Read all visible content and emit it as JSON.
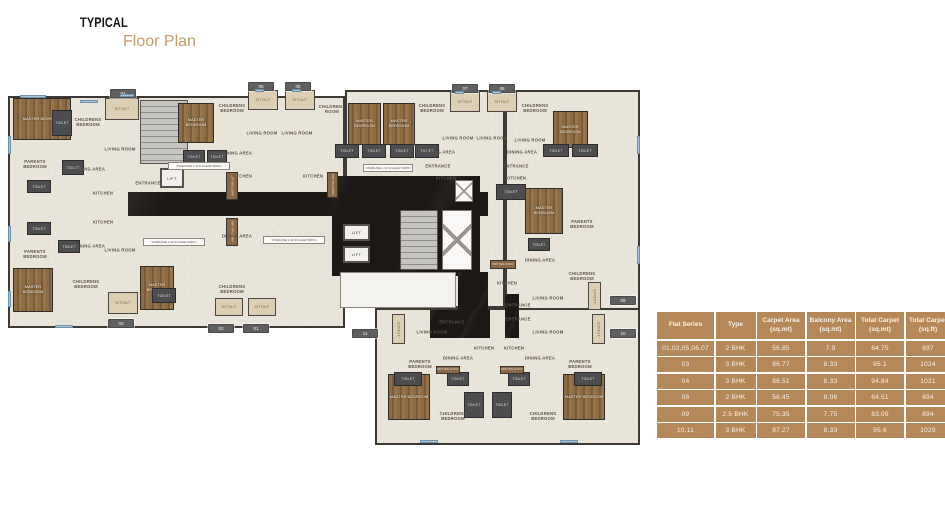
{
  "title": {
    "line1": "TYPICAL",
    "line2": "Floor Plan"
  },
  "colors": {
    "accent_gold": "#c49a6b",
    "table_tan": "#b5885a",
    "plan_floor_cream": "#e9e4d9",
    "plan_wall_dark": "#3d3a35",
    "plan_corridor_black": "#1b1815",
    "plan_wood_brown": "#85643f",
    "plan_toilet_gray": "#4d4d4f",
    "window_blue": "#a7c4da"
  },
  "table": {
    "headers": [
      "Flat Series",
      "Type",
      "Carpet Area (sq.mt)",
      "Balcony Area (sq.mt)",
      "Total Carpet (sq.mt)",
      "Total Carpet (sq.ft)"
    ],
    "rows": [
      [
        "01,02,05,06,07",
        "2 BHK",
        "56.85",
        "7.9",
        "64.75",
        "697"
      ],
      [
        "03",
        "3 BHK",
        "86.77",
        "8.33",
        "95.1",
        "1024"
      ],
      [
        "04",
        "3 BHK",
        "86.51",
        "8.33",
        "94.84",
        "1021"
      ],
      [
        "08",
        "2 BHK",
        "56.45",
        "8.06",
        "64.51",
        "694"
      ],
      [
        "09",
        "2.5 BHK",
        "75.35",
        "7.75",
        "83.09",
        "894"
      ],
      [
        "10,11",
        "3 BHK",
        "87.27",
        "8.33",
        "95.6",
        "1029"
      ]
    ]
  },
  "floor_plan": {
    "wings": [
      {
        "x": 8,
        "y": 20,
        "w": 337,
        "h": 232
      },
      {
        "x": 345,
        "y": 14,
        "w": 160,
        "h": 218
      },
      {
        "x": 505,
        "y": 14,
        "w": 135,
        "h": 238
      },
      {
        "x": 375,
        "y": 232,
        "w": 265,
        "h": 137
      }
    ],
    "corridors": [
      {
        "x": 128,
        "y": 116,
        "w": 360,
        "h": 24
      },
      {
        "x": 332,
        "y": 100,
        "w": 148,
        "h": 100
      },
      {
        "x": 458,
        "y": 196,
        "w": 30,
        "h": 66
      },
      {
        "x": 430,
        "y": 234,
        "w": 60,
        "h": 28
      },
      {
        "x": 505,
        "y": 218,
        "w": 14,
        "h": 44
      }
    ],
    "lobbies": [
      {
        "x": 340,
        "y": 196,
        "w": 116,
        "h": 36
      }
    ],
    "stairs": [
      {
        "x": 140,
        "y": 24,
        "w": 48,
        "h": 64
      },
      {
        "x": 400,
        "y": 134,
        "w": 38,
        "h": 60
      }
    ],
    "shafts": [
      {
        "x": 442,
        "y": 134,
        "w": 30,
        "h": 60
      },
      {
        "x": 455,
        "y": 104,
        "w": 18,
        "h": 22
      }
    ],
    "lifts": [
      {
        "label": "LIFT",
        "x": 160,
        "y": 92,
        "w": 24,
        "h": 20
      },
      {
        "label": "LIFT",
        "x": 343,
        "y": 148,
        "w": 27,
        "h": 17
      },
      {
        "label": "LIFT",
        "x": 343,
        "y": 170,
        "w": 27,
        "h": 17
      }
    ],
    "wood_rooms": [
      {
        "label": "MASTER BEDROOM",
        "x": 13,
        "y": 22,
        "w": 58,
        "h": 42
      },
      {
        "label": "MASTER BEDROOM",
        "x": 178,
        "y": 27,
        "w": 36,
        "h": 40
      },
      {
        "label": "MASTER BEDROOM",
        "x": 348,
        "y": 27,
        "w": 33,
        "h": 42
      },
      {
        "label": "MASTER BEDROOM",
        "x": 383,
        "y": 27,
        "w": 32,
        "h": 42
      },
      {
        "label": "MASTER BEDROOM",
        "x": 553,
        "y": 35,
        "w": 35,
        "h": 37
      },
      {
        "label": "MASTER BEDROOM",
        "x": 525,
        "y": 112,
        "w": 38,
        "h": 46
      },
      {
        "label": "MASTER BEDROOM",
        "x": 13,
        "y": 192,
        "w": 40,
        "h": 44
      },
      {
        "label": "MASTER BEDROOM",
        "x": 140,
        "y": 190,
        "w": 34,
        "h": 44
      },
      {
        "label": "MASTER BEDROOM",
        "x": 388,
        "y": 298,
        "w": 42,
        "h": 46
      },
      {
        "label": "MASTER BEDROOM",
        "x": 563,
        "y": 298,
        "w": 42,
        "h": 46
      }
    ],
    "toilets": [
      {
        "x": 52,
        "y": 34,
        "w": 20,
        "h": 26
      },
      {
        "x": 62,
        "y": 84,
        "w": 22,
        "h": 15
      },
      {
        "x": 27,
        "y": 104,
        "w": 24,
        "h": 13
      },
      {
        "x": 27,
        "y": 146,
        "w": 24,
        "h": 13
      },
      {
        "x": 58,
        "y": 164,
        "w": 22,
        "h": 13
      },
      {
        "x": 152,
        "y": 212,
        "w": 24,
        "h": 15
      },
      {
        "x": 183,
        "y": 74,
        "w": 22,
        "h": 13
      },
      {
        "x": 207,
        "y": 74,
        "w": 20,
        "h": 13
      },
      {
        "x": 335,
        "y": 68,
        "w": 24,
        "h": 14
      },
      {
        "x": 362,
        "y": 68,
        "w": 24,
        "h": 14
      },
      {
        "x": 390,
        "y": 68,
        "w": 24,
        "h": 14
      },
      {
        "x": 415,
        "y": 68,
        "w": 24,
        "h": 14
      },
      {
        "x": 496,
        "y": 108,
        "w": 30,
        "h": 16
      },
      {
        "x": 543,
        "y": 68,
        "w": 26,
        "h": 13
      },
      {
        "x": 572,
        "y": 68,
        "w": 26,
        "h": 13
      },
      {
        "x": 528,
        "y": 162,
        "w": 22,
        "h": 13
      },
      {
        "x": 447,
        "y": 296,
        "w": 22,
        "h": 14
      },
      {
        "x": 508,
        "y": 296,
        "w": 22,
        "h": 14
      },
      {
        "x": 394,
        "y": 296,
        "w": 28,
        "h": 14
      },
      {
        "x": 574,
        "y": 296,
        "w": 28,
        "h": 14
      },
      {
        "x": 464,
        "y": 316,
        "w": 20,
        "h": 26
      },
      {
        "x": 492,
        "y": 316,
        "w": 20,
        "h": 26
      }
    ],
    "sitouts": [
      {
        "label": "SITOUT",
        "x": 105,
        "y": 22,
        "w": 34,
        "h": 22,
        "vert": false
      },
      {
        "label": "SITOUT",
        "x": 248,
        "y": 14,
        "w": 30,
        "h": 20,
        "vert": false
      },
      {
        "label": "SITOUT",
        "x": 285,
        "y": 14,
        "w": 30,
        "h": 20,
        "vert": false
      },
      {
        "label": "SITOUT",
        "x": 450,
        "y": 16,
        "w": 30,
        "h": 20,
        "vert": false
      },
      {
        "label": "SITOUT",
        "x": 487,
        "y": 16,
        "w": 30,
        "h": 20,
        "vert": false
      },
      {
        "label": "SITOUT",
        "x": 108,
        "y": 216,
        "w": 30,
        "h": 22,
        "vert": false
      },
      {
        "label": "SITOUT",
        "x": 215,
        "y": 222,
        "w": 28,
        "h": 18,
        "vert": false
      },
      {
        "label": "SITOUT",
        "x": 248,
        "y": 222,
        "w": 28,
        "h": 18,
        "vert": false
      },
      {
        "label": "SITOUT",
        "x": 392,
        "y": 238,
        "w": 13,
        "h": 30,
        "vert": true
      },
      {
        "label": "SITOUT",
        "x": 592,
        "y": 238,
        "w": 13,
        "h": 30,
        "vert": true
      },
      {
        "label": "SITOUT",
        "x": 588,
        "y": 206,
        "w": 13,
        "h": 28,
        "vert": true
      }
    ],
    "balconies": [
      {
        "label": "DRY BALCONY",
        "x": 226,
        "y": 96,
        "w": 12,
        "h": 28,
        "vert": true
      },
      {
        "label": "DRY BALCONY",
        "x": 226,
        "y": 142,
        "w": 12,
        "h": 28,
        "vert": true
      },
      {
        "label": "DRY BALCONY",
        "x": 327,
        "y": 96,
        "w": 11,
        "h": 26,
        "vert": true
      },
      {
        "label": "DRY BALCONY",
        "x": 490,
        "y": 184,
        "w": 26,
        "h": 9,
        "vert": false
      },
      {
        "label": "DRY BALCONY",
        "x": 436,
        "y": 290,
        "w": 24,
        "h": 8,
        "vert": false
      },
      {
        "label": "DRY BALCONY",
        "x": 500,
        "y": 290,
        "w": 24,
        "h": 8,
        "vert": false
      }
    ],
    "strips": [
      {
        "label": "STAIRCASE 1.40 M CLEAR WIDTH",
        "x": 168,
        "y": 86,
        "w": 62,
        "h": 8
      },
      {
        "label": "STAIRCASE 1.40 M CLEAR WIDTH",
        "x": 143,
        "y": 162,
        "w": 62,
        "h": 8
      },
      {
        "label": "STAIRCASE 1.40 M CLEAR WIDTH",
        "x": 263,
        "y": 160,
        "w": 62,
        "h": 8
      },
      {
        "label": "STAIRCASE 1.40 M CLEAR WIDTH",
        "x": 363,
        "y": 88,
        "w": 50,
        "h": 8
      }
    ],
    "room_labels": [
      {
        "label": "CHILDRENS BEDROOM",
        "x": 88,
        "y": 46
      },
      {
        "label": "PARENTS BEDROOM",
        "x": 35,
        "y": 88
      },
      {
        "label": "DINING AREA",
        "x": 90,
        "y": 93
      },
      {
        "label": "LIVING ROOM",
        "x": 120,
        "y": 73
      },
      {
        "label": "KITCHEN",
        "x": 103,
        "y": 117
      },
      {
        "label": "KITCHEN",
        "x": 103,
        "y": 146
      },
      {
        "label": "DINING AREA",
        "x": 90,
        "y": 170
      },
      {
        "label": "PARENTS BEDROOM",
        "x": 35,
        "y": 178
      },
      {
        "label": "LIVING ROOM",
        "x": 120,
        "y": 174
      },
      {
        "label": "CHILDRENS BEDROOM",
        "x": 86,
        "y": 208
      },
      {
        "label": "CHILDRENS BEDROOM",
        "x": 232,
        "y": 32
      },
      {
        "label": "DINING AREA",
        "x": 237,
        "y": 77
      },
      {
        "label": "KITCHEN",
        "x": 242,
        "y": 100
      },
      {
        "label": "LIVING ROOM",
        "x": 262,
        "y": 57
      },
      {
        "label": "LIVING ROOM",
        "x": 297,
        "y": 57
      },
      {
        "label": "KITCHEN",
        "x": 313,
        "y": 100
      },
      {
        "label": "DINING AREA",
        "x": 237,
        "y": 160
      },
      {
        "label": "CHILDRENS BEDROOM",
        "x": 232,
        "y": 213
      },
      {
        "label": "CHILDRENS ROOM",
        "x": 332,
        "y": 33
      },
      {
        "label": "CHILDRENS BEDROOM",
        "x": 432,
        "y": 32
      },
      {
        "label": "CHILDRENS BEDROOM",
        "x": 535,
        "y": 32
      },
      {
        "label": "LIVING ROOM",
        "x": 458,
        "y": 62
      },
      {
        "label": "LIVING ROOM",
        "x": 492,
        "y": 62
      },
      {
        "label": "LIVING ROOM",
        "x": 530,
        "y": 64
      },
      {
        "label": "DINING AREA",
        "x": 440,
        "y": 76
      },
      {
        "label": "DINING AREA",
        "x": 522,
        "y": 76
      },
      {
        "label": "KITCHEN",
        "x": 446,
        "y": 102
      },
      {
        "label": "KITCHEN",
        "x": 516,
        "y": 102
      },
      {
        "label": "PARENTS BEDROOM",
        "x": 582,
        "y": 148
      },
      {
        "label": "CHILDRENS BEDROOM",
        "x": 582,
        "y": 200
      },
      {
        "label": "DINING AREA",
        "x": 540,
        "y": 184
      },
      {
        "label": "KITCHEN",
        "x": 507,
        "y": 207
      },
      {
        "label": "LIVING ROOM",
        "x": 548,
        "y": 222
      },
      {
        "label": "LIVING ROOM",
        "x": 432,
        "y": 256
      },
      {
        "label": "LIVING ROOM",
        "x": 548,
        "y": 256
      },
      {
        "label": "KITCHEN",
        "x": 484,
        "y": 272
      },
      {
        "label": "KITCHEN",
        "x": 514,
        "y": 272
      },
      {
        "label": "DINING AREA",
        "x": 458,
        "y": 282
      },
      {
        "label": "DINING AREA",
        "x": 540,
        "y": 282
      },
      {
        "label": "PARENTS BEDROOM",
        "x": 420,
        "y": 288
      },
      {
        "label": "PARENTS BEDROOM",
        "x": 580,
        "y": 288
      },
      {
        "label": "CHILDRENS BEDROOM",
        "x": 453,
        "y": 340
      },
      {
        "label": "CHILDRENS BEDROOM",
        "x": 543,
        "y": 340
      },
      {
        "label": "ENTRANCE",
        "x": 148,
        "y": 107
      },
      {
        "label": "ENTRANCE",
        "x": 438,
        "y": 90
      },
      {
        "label": "ENTRANCE",
        "x": 516,
        "y": 90
      },
      {
        "label": "ENTRANCE",
        "x": 452,
        "y": 246
      },
      {
        "label": "ENTRANCE",
        "x": 518,
        "y": 229
      },
      {
        "label": "ENTRANCE",
        "x": 518,
        "y": 243
      }
    ],
    "unit_tags": [
      {
        "label": "04",
        "x": 110,
        "y": 13
      },
      {
        "label": "05",
        "x": 248,
        "y": 6
      },
      {
        "label": "06",
        "x": 285,
        "y": 6
      },
      {
        "label": "07",
        "x": 452,
        "y": 8
      },
      {
        "label": "08",
        "x": 489,
        "y": 8
      },
      {
        "label": "03",
        "x": 108,
        "y": 243
      },
      {
        "label": "02",
        "x": 208,
        "y": 248
      },
      {
        "label": "01",
        "x": 243,
        "y": 248
      },
      {
        "label": "09",
        "x": 610,
        "y": 220
      },
      {
        "label": "10",
        "x": 610,
        "y": 253
      },
      {
        "label": "11",
        "x": 352,
        "y": 253
      }
    ],
    "windows": [
      {
        "x": 20,
        "y": 19,
        "w": 26,
        "h": 3
      },
      {
        "x": 80,
        "y": 24,
        "w": 18,
        "h": 3
      },
      {
        "x": 8,
        "y": 60,
        "w": 3,
        "h": 18
      },
      {
        "x": 8,
        "y": 150,
        "w": 3,
        "h": 16
      },
      {
        "x": 8,
        "y": 215,
        "w": 3,
        "h": 16
      },
      {
        "x": 55,
        "y": 249,
        "w": 18,
        "h": 3
      },
      {
        "x": 255,
        "y": 13,
        "w": 9,
        "h": 3
      },
      {
        "x": 292,
        "y": 13,
        "w": 9,
        "h": 3
      },
      {
        "x": 455,
        "y": 15,
        "w": 9,
        "h": 3
      },
      {
        "x": 492,
        "y": 15,
        "w": 9,
        "h": 3
      },
      {
        "x": 637,
        "y": 60,
        "w": 3,
        "h": 18
      },
      {
        "x": 637,
        "y": 170,
        "w": 3,
        "h": 18
      },
      {
        "x": 420,
        "y": 364,
        "w": 18,
        "h": 3
      },
      {
        "x": 560,
        "y": 364,
        "w": 18,
        "h": 3
      },
      {
        "x": 120,
        "y": 18,
        "w": 14,
        "h": 3
      }
    ]
  }
}
